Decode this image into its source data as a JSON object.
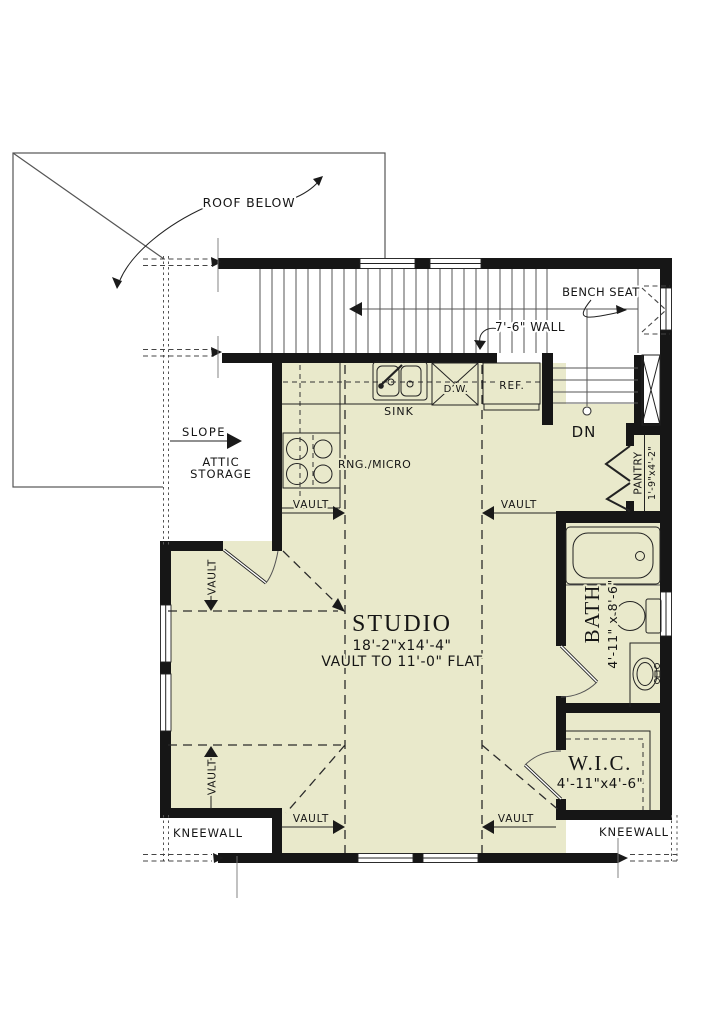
{
  "annotations": {
    "roof_below": "ROOF BELOW",
    "bench_seat": "BENCH SEAT",
    "wall_height": "7'-6\" WALL",
    "down": "DN",
    "slope": "SLOPE",
    "attic_line1": "ATTIC",
    "attic_line2": "STORAGE",
    "vault": "VAULT",
    "kneewall": "KNEEWALL"
  },
  "kitchen": {
    "sink": "SINK",
    "dishwasher": "D.W.",
    "refrigerator": "REF.",
    "range_micro": "RNG./MICRO"
  },
  "rooms": {
    "studio": {
      "name": "STUDIO",
      "dims": "18'-2\"x14'-4\"",
      "ceiling": "VAULT TO 11'-0\" FLAT"
    },
    "bath": {
      "name": "BATH",
      "dims": "4'-11\" x 8'-6\""
    },
    "wic": {
      "name": "W.I.C.",
      "dims": "4'-11\"x4'-6\""
    },
    "pantry": {
      "name": "PANTRY",
      "dims": "1'-9\"x4'-2\""
    }
  },
  "colors": {
    "floor": "#e9e9cb",
    "wall": "#161616",
    "line": "#3a3a3a"
  }
}
